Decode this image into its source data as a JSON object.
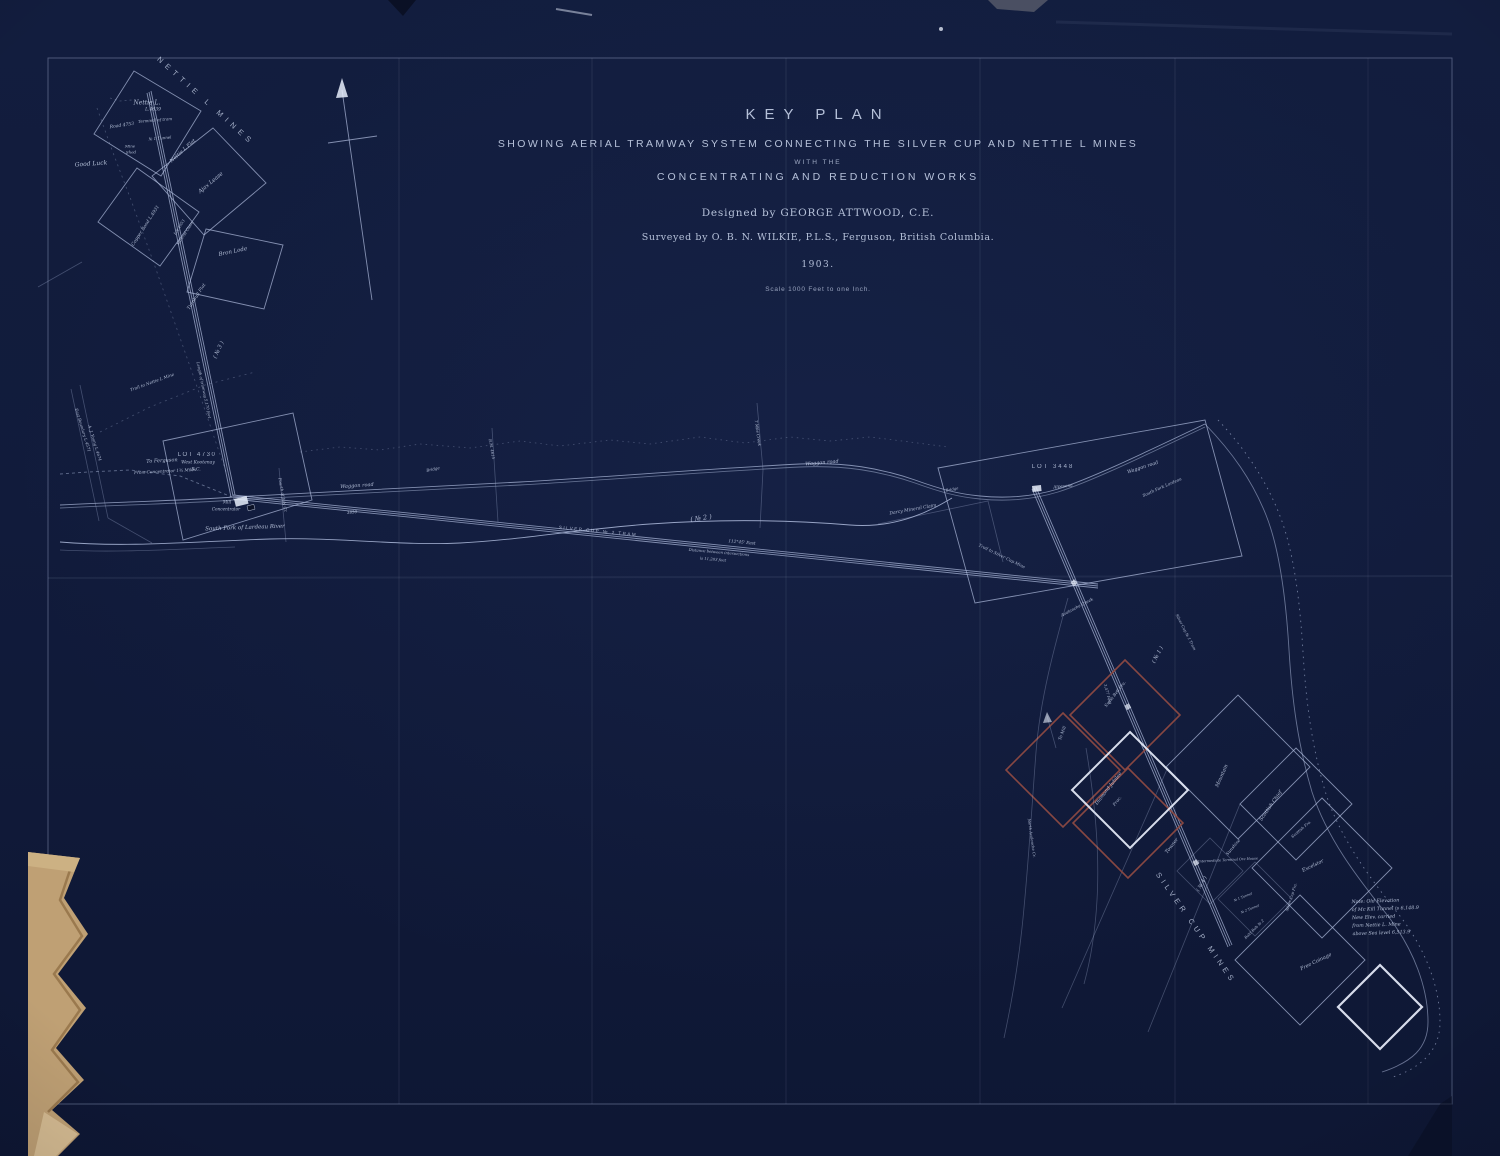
{
  "title_block": {
    "title": "KEY  PLAN",
    "subtitle1": "SHOWING  AERIAL  TRAMWAY  SYSTEM  CONNECTING  THE  SILVER  CUP  AND  NETTIE  L  MINES",
    "subtitle2": "WITH  THE",
    "subtitle3": "CONCENTRATING  AND  REDUCTION  WORKS",
    "designed_by": "Designed by GEORGE ATTWOOD, C.E.",
    "surveyed_by": "Surveyed by O. B. N. WILKIE, P.L.S., Ferguson, British Columbia.",
    "year": "1903.",
    "scale": "Scale 1000 Feet to one Inch."
  },
  "colors": {
    "bg": "#111c3d",
    "line": "#aebbdc",
    "text": "#ccd7ee",
    "red": "#8e4a42",
    "tan": "#bfa074",
    "tan_dark": "#8d6c42",
    "bright": "#e8eefb"
  },
  "map": {
    "labels": [
      {
        "name": "label-nettie-l-mines-arc",
        "text": "NETTIE  L  MINES",
        "x": 206,
        "y": 101,
        "rot": 42,
        "size": 7.5,
        "spacing": 5,
        "caps": true
      },
      {
        "name": "label-nettie-l-claim",
        "text": "Nettie L.",
        "x": 147,
        "y": 103,
        "rot": 0,
        "size": 6
      },
      {
        "name": "label-nettie-l-number",
        "text": "L.4639",
        "x": 153,
        "y": 110,
        "rot": 0,
        "size": 4.5
      },
      {
        "name": "label-road-4753",
        "text": "Road 4753",
        "x": 122,
        "y": 126,
        "rot": -8,
        "size": 4.5
      },
      {
        "name": "label-terminal-of-tram",
        "text": "Terminal of tram",
        "x": 155,
        "y": 120,
        "rot": -5,
        "size": 4
      },
      {
        "name": "label-no1-tunnel-nw",
        "text": "№ 1 Tunnel",
        "x": 160,
        "y": 138,
        "rot": -5,
        "size": 4
      },
      {
        "name": "label-mine",
        "text": "Mine",
        "x": 130,
        "y": 146,
        "rot": 0,
        "size": 4
      },
      {
        "name": "label-shed",
        "text": "Shed",
        "x": 131,
        "y": 152,
        "rot": 0,
        "size": 4
      },
      {
        "name": "label-good-luck",
        "text": "Good Luck",
        "x": 91,
        "y": 164,
        "rot": -4,
        "size": 6
      },
      {
        "name": "label-nettie-l-flat",
        "text": "Nettie L Flat",
        "x": 183,
        "y": 151,
        "rot": -42,
        "size": 5
      },
      {
        "name": "label-ajax-lease",
        "text": "Ajax Lease",
        "x": 211,
        "y": 183,
        "rot": -40,
        "size": 5.5
      },
      {
        "name": "label-copper-bond",
        "text": "Copper Bond L.4931",
        "x": 146,
        "y": 226,
        "rot": -57,
        "size": 4.5
      },
      {
        "name": "label-lot-4953",
        "text": "Lot 4953",
        "x": 179,
        "y": 227,
        "rot": -57,
        "size": 3.8
      },
      {
        "name": "label-lot-4953-mineral",
        "text": "Mineral Claim",
        "x": 185,
        "y": 233,
        "rot": -57,
        "size": 3.8
      },
      {
        "name": "label-bron-lode",
        "text": "Bron Lode",
        "x": 233,
        "y": 252,
        "rot": -12,
        "size": 5.5
      },
      {
        "name": "label-turnbull-flat",
        "text": "Turnbull Flat",
        "x": 197,
        "y": 297,
        "rot": -57,
        "size": 4.5
      },
      {
        "name": "label-no3-tram",
        "text": "( № 3 )",
        "x": 219,
        "y": 350,
        "rot": -65,
        "size": 5.5
      },
      {
        "name": "label-tram3-length",
        "text": "Length of tramway 5,170 feet",
        "x": 204,
        "y": 390,
        "rot": 78,
        "size": 3.8
      },
      {
        "name": "label-trail-to-nettie-l",
        "text": "Trail to Nettie L Mine",
        "x": 152,
        "y": 382,
        "rot": -20,
        "size": 4.2
      },
      {
        "name": "label-east-boundary",
        "text": "East Boundary L.4571",
        "x": 83,
        "y": 430,
        "rot": 73,
        "size": 4
      },
      {
        "name": "label-a-j-young",
        "text": "A. J. Young L.4674",
        "x": 95,
        "y": 443,
        "rot": 73,
        "size": 4
      },
      {
        "name": "label-to-ferguson",
        "text": "To Ferguson",
        "x": 162,
        "y": 461,
        "rot": -3,
        "size": 5
      },
      {
        "name": "label-from-concentrator",
        "text": "From Concentrator 1¾ Miles",
        "x": 165,
        "y": 471,
        "rot": -3,
        "size": 4.2
      },
      {
        "name": "label-lot-4730",
        "text": "LOT 4730",
        "x": 197,
        "y": 455,
        "rot": 0,
        "size": 6,
        "spacing": 1.5,
        "caps": true
      },
      {
        "name": "label-west-kootenay",
        "text": "West Kootenay",
        "x": 198,
        "y": 463,
        "rot": 0,
        "size": 4.5
      },
      {
        "name": "label-bc",
        "text": "B.C.",
        "x": 196,
        "y": 470,
        "rot": 0,
        "size": 4.5
      },
      {
        "name": "label-mill",
        "text": "Mill",
        "x": 227,
        "y": 502,
        "rot": 0,
        "size": 4.2
      },
      {
        "name": "label-concentrator",
        "text": "Concentrator",
        "x": 226,
        "y": 509,
        "rot": 0,
        "size": 4.2
      },
      {
        "name": "label-south-fork-lardeau-river",
        "text": "South Fork of Lardeau River",
        "x": 245,
        "y": 528,
        "rot": -2,
        "size": 5.5
      },
      {
        "name": "label-fourth-of-july-creek",
        "text": "Fourth of July Cr.",
        "x": 283,
        "y": 495,
        "rot": 80,
        "size": 4
      },
      {
        "name": "label-waggon-road-1",
        "text": "Waggon road",
        "x": 357,
        "y": 486,
        "rot": -4,
        "size": 5
      },
      {
        "name": "label-elevation-3850",
        "text": "3850",
        "x": 352,
        "y": 512,
        "rot": -5,
        "size": 4
      },
      {
        "name": "label-bridge-1",
        "text": "Bridge",
        "x": 433,
        "y": 469,
        "rot": -12,
        "size": 4
      },
      {
        "name": "label-bm-4615",
        "text": "B.M. 4615",
        "x": 492,
        "y": 449,
        "rot": 80,
        "size": 3.8
      },
      {
        "name": "label-silver-cup-no2-tram",
        "text": "SILVER CUP  № 2  TRAM",
        "x": 598,
        "y": 531,
        "rot": 5.5,
        "size": 4.5,
        "spacing": 1.5,
        "caps": true
      },
      {
        "name": "label-no2-tram",
        "text": "( № 2 )",
        "x": 701,
        "y": 518,
        "rot": -8,
        "size": 6.5
      },
      {
        "name": "label-bearing",
        "text": "112°45' East",
        "x": 742,
        "y": 542,
        "rot": 5,
        "size": 4.2
      },
      {
        "name": "label-distance-1",
        "text": "Distance between intersections",
        "x": 719,
        "y": 552,
        "rot": 5,
        "size": 3.8
      },
      {
        "name": "label-distance-2",
        "text": "is 11,283 feet",
        "x": 713,
        "y": 559,
        "rot": 5,
        "size": 3.8
      },
      {
        "name": "label-seven-mile-creek",
        "text": "7 Mile Creek",
        "x": 758,
        "y": 433,
        "rot": 82,
        "size": 4
      },
      {
        "name": "label-waggon-road-2",
        "text": "Waggon road",
        "x": 822,
        "y": 463,
        "rot": -5,
        "size": 5
      },
      {
        "name": "label-darcy-mineral-claim",
        "text": "Darcy Mineral Claim",
        "x": 913,
        "y": 510,
        "rot": -10,
        "size": 4.5
      },
      {
        "name": "label-bridge-2",
        "text": "Bridge",
        "x": 952,
        "y": 489,
        "rot": -10,
        "size": 3.8
      },
      {
        "name": "label-lot-3448",
        "text": "LOT 3448",
        "x": 1053,
        "y": 467,
        "rot": 0,
        "size": 6,
        "spacing": 2,
        "caps": true
      },
      {
        "name": "label-alpesona",
        "text": "Alpesona",
        "x": 1063,
        "y": 486,
        "rot": -6,
        "size": 4.2
      },
      {
        "name": "label-waggon-road-3",
        "text": "Waggon road",
        "x": 1143,
        "y": 468,
        "rot": -18,
        "size": 4.8
      },
      {
        "name": "label-south-fork-lardeau",
        "text": "South Fork Lardeau",
        "x": 1162,
        "y": 487,
        "rot": -24,
        "size": 4.2
      },
      {
        "name": "label-trail-to-silver-cup",
        "text": "Trail to Silver Cup Mine",
        "x": 1002,
        "y": 556,
        "rot": 26,
        "size": 4.2
      },
      {
        "name": "label-avalanche-creek",
        "text": "Avalanche Creek",
        "x": 1077,
        "y": 607,
        "rot": -28,
        "size": 4.2
      },
      {
        "name": "label-no1-tram",
        "text": "( № 1 )",
        "x": 1158,
        "y": 655,
        "rot": -62,
        "size": 5.5
      },
      {
        "name": "label-silver-cup-no1-tram",
        "text": "Silver Cup № 1 Tram",
        "x": 1186,
        "y": 632,
        "rot": 63,
        "size": 3.8
      },
      {
        "name": "label-3477-feet",
        "text": "3,477 Feet",
        "x": 1108,
        "y": 694,
        "rot": 75,
        "size": 3.8
      },
      {
        "name": "label-to-mill",
        "text": "To Mill",
        "x": 1062,
        "y": 733,
        "rot": -70,
        "size": 4.2
      },
      {
        "name": "label-swiss-bell",
        "text": "Swiss Bell Fra.",
        "x": 1115,
        "y": 694,
        "rot": -52,
        "size": 4.2
      },
      {
        "name": "label-diamond-jubilee",
        "text": "Diamond Jubilee",
        "x": 1109,
        "y": 789,
        "rot": -52,
        "size": 4.8
      },
      {
        "name": "label-diamond-jubilee-frac",
        "text": "Frac.",
        "x": 1117,
        "y": 801,
        "rot": -52,
        "size": 4.2
      },
      {
        "name": "label-towser",
        "text": "Towser",
        "x": 1172,
        "y": 846,
        "rot": -52,
        "size": 5
      },
      {
        "name": "label-mountain",
        "text": "Mountain",
        "x": 1222,
        "y": 776,
        "rot": -66,
        "size": 5
      },
      {
        "name": "label-sunshine",
        "text": "Sunshine",
        "x": 1233,
        "y": 847,
        "rot": -50,
        "size": 4.2
      },
      {
        "name": "label-no4-tram",
        "text": "( № 4 )",
        "x": 1202,
        "y": 884,
        "rot": -60,
        "size": 5
      },
      {
        "name": "label-intermediate-terminal",
        "text": "Intermediate Terminal Ore House",
        "x": 1228,
        "y": 860,
        "rot": -3,
        "size": 3.5
      },
      {
        "name": "label-scottish-chief",
        "text": "Scottish Chief",
        "x": 1271,
        "y": 806,
        "rot": -55,
        "size": 5
      },
      {
        "name": "label-scottish-fra",
        "text": "Scottish Fra.",
        "x": 1301,
        "y": 829,
        "rot": -40,
        "size": 3.8
      },
      {
        "name": "label-excelsior",
        "text": "Excelsior",
        "x": 1313,
        "y": 866,
        "rot": -26,
        "size": 5
      },
      {
        "name": "label-silver-cup-fra",
        "text": "Silver Cup Fra.",
        "x": 1291,
        "y": 897,
        "rot": -72,
        "size": 3.8
      },
      {
        "name": "label-no1-tunnel",
        "text": "№ 1 Tunnel",
        "x": 1243,
        "y": 897,
        "rot": -22,
        "size": 3.4
      },
      {
        "name": "label-no2-tunnel",
        "text": "№ 2 Tunnel",
        "x": 1250,
        "y": 909,
        "rot": -22,
        "size": 3.4
      },
      {
        "name": "label-bald-bob",
        "text": "Bald Bob № 2",
        "x": 1254,
        "y": 929,
        "rot": -45,
        "size": 3.8
      },
      {
        "name": "label-free-coinage",
        "text": "Free Coinage",
        "x": 1316,
        "y": 962,
        "rot": -26,
        "size": 5
      },
      {
        "name": "label-silver-cup-mines-arc",
        "text": "SILVER  CUP  MINES",
        "x": 1196,
        "y": 928,
        "rot": 55,
        "size": 7.5,
        "spacing": 4,
        "caps": true
      },
      {
        "name": "label-north-avalanche",
        "text": "North Avalanche Cr.",
        "x": 1032,
        "y": 838,
        "rot": 82,
        "size": 3.8
      }
    ],
    "note": {
      "x": 1352,
      "y": 898,
      "rot": -2,
      "lines": [
        "Note: Old Elevation",
        "of Mc Kill Tunnel is 6,148.9",
        "New Elev. carried",
        "from Nettie L. Mine",
        "above Sea level  6,513.9"
      ]
    }
  }
}
